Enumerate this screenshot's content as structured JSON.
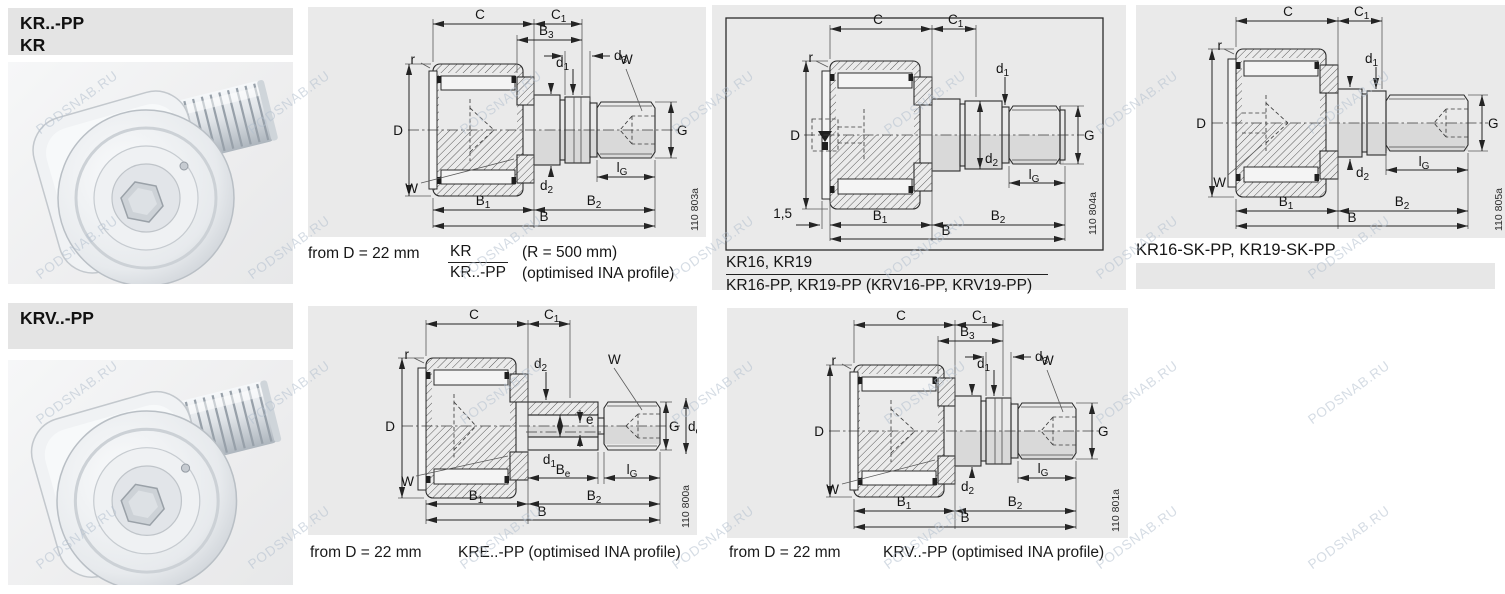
{
  "watermark": "PODSNAB.RU",
  "page": {
    "panel_color": "#eaeaea",
    "header_color": "#e4e4e4",
    "line_color": "#2b2b2b",
    "section_fill": "#d9d9d9",
    "watermark_color": "#b3bfce"
  },
  "headers": {
    "kr": {
      "line1": "KR..-PP",
      "line2": "KR"
    },
    "krv": {
      "line1": "KRV..-PP"
    }
  },
  "figures": {
    "fig1": {
      "id": "110 803a",
      "caption": {
        "prefix": "from D = 22 mm",
        "fraction_top": "KR",
        "fraction_bottom": "KR..-PP",
        "note1": "(R = 500 mm)",
        "note2": "(optimised INA profile)"
      }
    },
    "fig2": {
      "id": "110 804a",
      "caption": {
        "line1": "KR16, KR19",
        "line2": "KR16-PP, KR19-PP (KRV16-PP, KRV19-PP)"
      }
    },
    "fig3": {
      "id": "110 805a",
      "caption": {
        "line1": "KR16-SK-PP, KR19-SK-PP"
      }
    },
    "fig4": {
      "id": "110 800a",
      "caption": {
        "prefix": "from D = 22 mm",
        "text": "KRE..-PP (optimised INA profile)"
      }
    },
    "fig5": {
      "id": "110 801a",
      "caption": {
        "prefix": "from D = 22 mm",
        "text": "KRV..-PP (optimised INA profile)"
      }
    }
  },
  "dims": {
    "C": "C",
    "C1": [
      "C",
      "1"
    ],
    "B3": [
      "B",
      "3"
    ],
    "d3": [
      "d",
      "3"
    ],
    "d1": [
      "d",
      "1"
    ],
    "d2": [
      "d",
      "2"
    ],
    "de": [
      "d",
      "e"
    ],
    "e": "e",
    "W": "W",
    "r": "r",
    "D": "D",
    "G": "G",
    "lG": [
      "l",
      "G"
    ],
    "Be": [
      "B",
      "e"
    ],
    "B1": [
      "B",
      "1"
    ],
    "B2": [
      "B",
      "2"
    ],
    "B": "B",
    "chamfer": "1,5"
  }
}
